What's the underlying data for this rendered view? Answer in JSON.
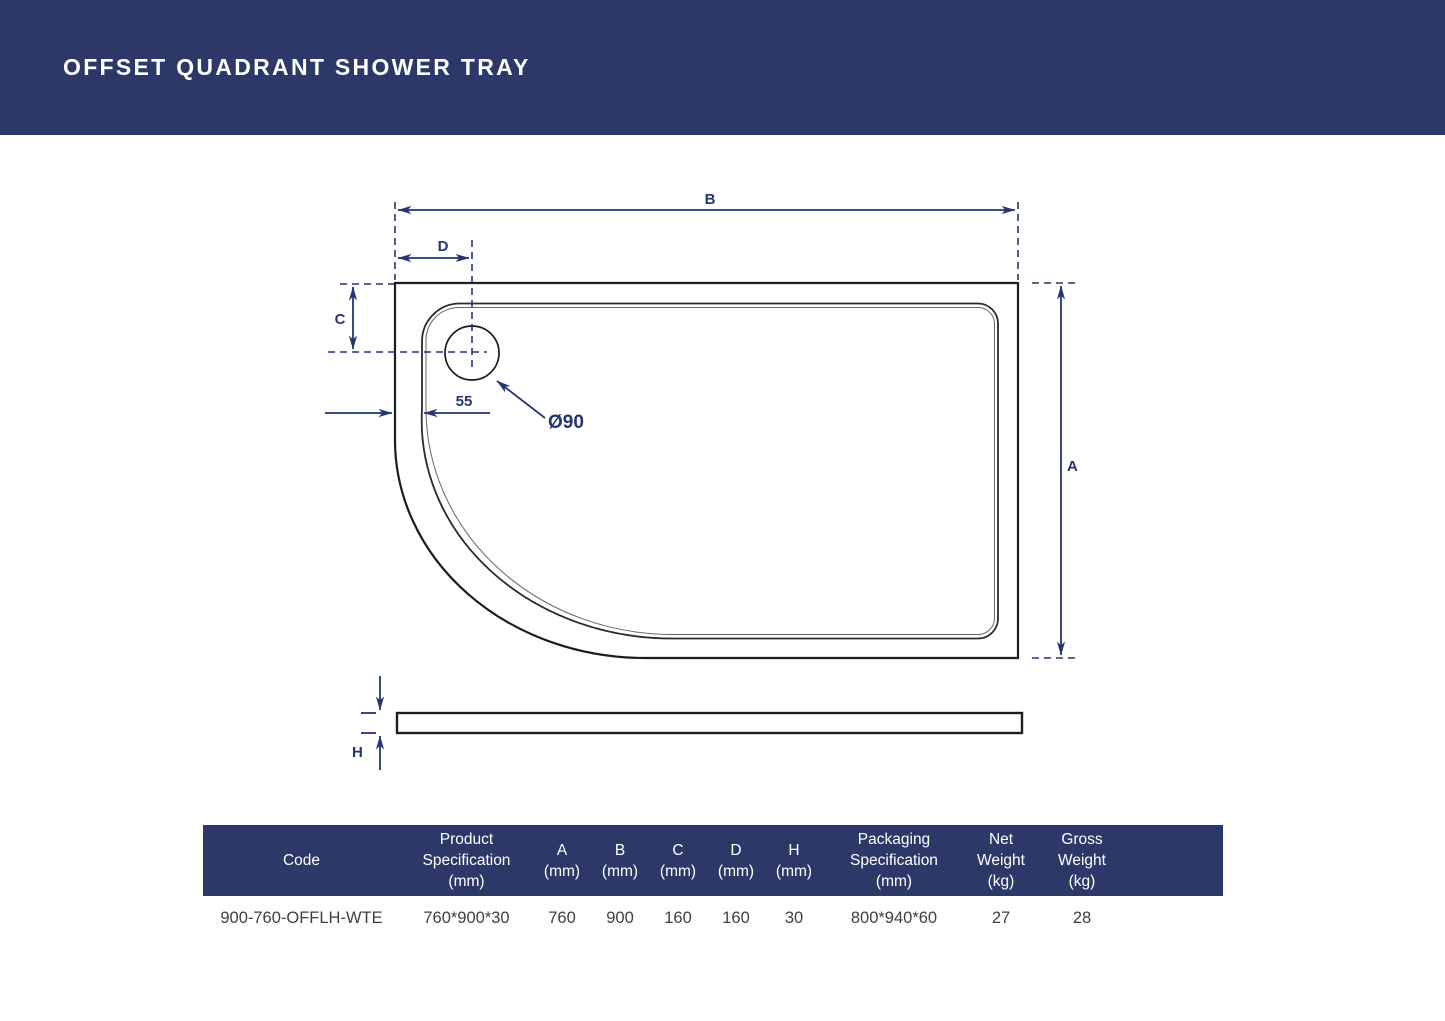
{
  "header": {
    "title": "OFFSET QUADRANT SHOWER TRAY",
    "bg_color": "#2c3968",
    "text_color": "#ffffff"
  },
  "diagram": {
    "labels": {
      "b": "B",
      "d": "D",
      "c": "C",
      "a": "A",
      "h": "H",
      "offset_55": "55",
      "drain_diameter": "Ø90"
    },
    "dimension_color": "#233572",
    "outline_color": "#1d1d1d"
  },
  "table": {
    "header_bg": "#2c3968",
    "header_text_color": "#ffffff",
    "columns": [
      {
        "id": "code",
        "label": "Code"
      },
      {
        "id": "product_spec",
        "label": "Product Specification (mm)"
      },
      {
        "id": "a",
        "label": "A (mm)"
      },
      {
        "id": "b",
        "label": "B (mm)"
      },
      {
        "id": "c",
        "label": "C (mm)"
      },
      {
        "id": "d",
        "label": "D (mm)"
      },
      {
        "id": "h",
        "label": "H (mm)"
      },
      {
        "id": "packaging_spec",
        "label": "Packaging Specification (mm)"
      },
      {
        "id": "net_weight",
        "label": "Net Weight (kg)"
      },
      {
        "id": "gross_weight",
        "label": "Gross Weight (kg)"
      }
    ],
    "rows": [
      {
        "code": "900-760-OFFLH-WTE",
        "product_spec": "760*900*30",
        "a": "760",
        "b": "900",
        "c": "160",
        "d": "160",
        "h": "30",
        "packaging_spec": "800*940*60",
        "net_weight": "27",
        "gross_weight": "28"
      }
    ]
  }
}
